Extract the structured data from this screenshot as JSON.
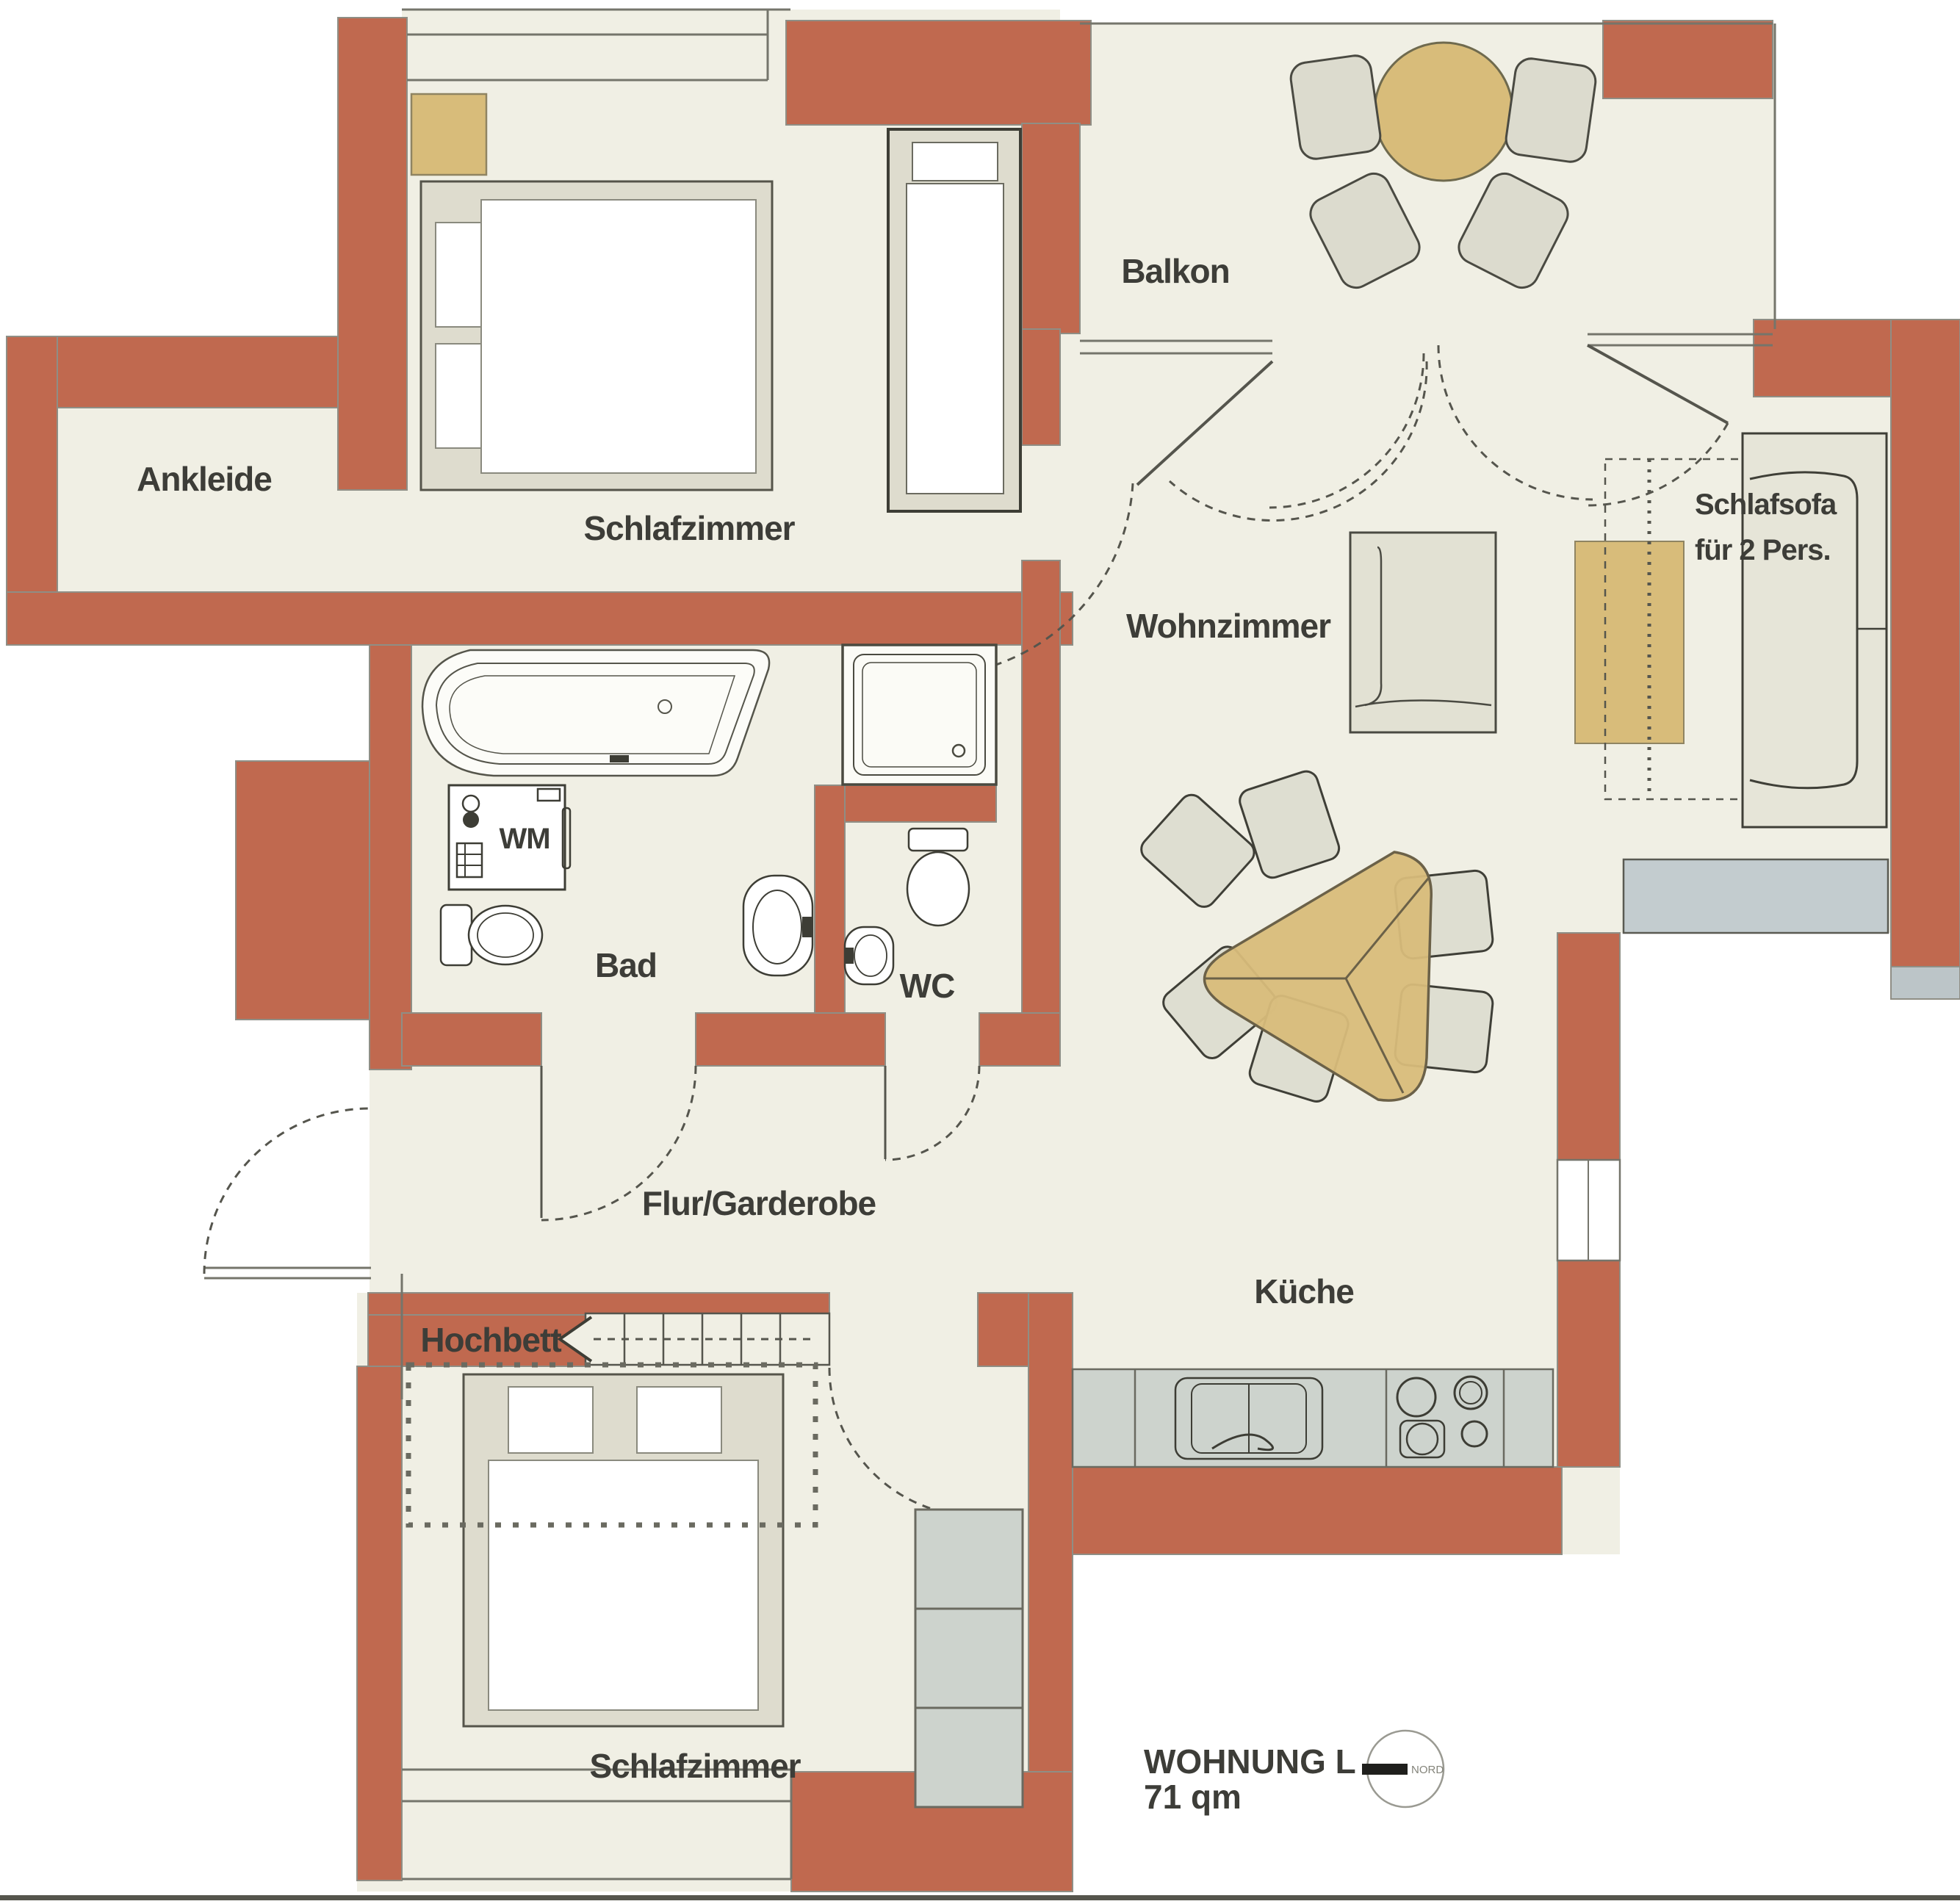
{
  "plan": {
    "title": "WOHNUNG L",
    "area": "71 qm",
    "compass": "NORD",
    "rooms": {
      "ankleide": "Ankleide",
      "schlafzimmer_top": "Schlafzimmer",
      "balkon": "Balkon",
      "wohnzimmer": "Wohnzimmer",
      "schlafsofa_line1": "Schlafsofa",
      "schlafsofa_line2": "für 2 Pers.",
      "bad": "Bad",
      "wc": "WC",
      "flur": "Flur/Garderobe",
      "kueche": "Küche",
      "hochbett": "Hochbett",
      "schlafzimmer_bottom": "Schlafzimmer"
    },
    "fixtures": {
      "washing_machine": "WM"
    },
    "colors": {
      "wall": "#c0694f",
      "floor": "#f0efe4",
      "accent_gold": "#d8bc7a",
      "furniture": "#e2e1d3",
      "cabinet": "#cdd3cd",
      "bench": "#c3cccf"
    }
  }
}
